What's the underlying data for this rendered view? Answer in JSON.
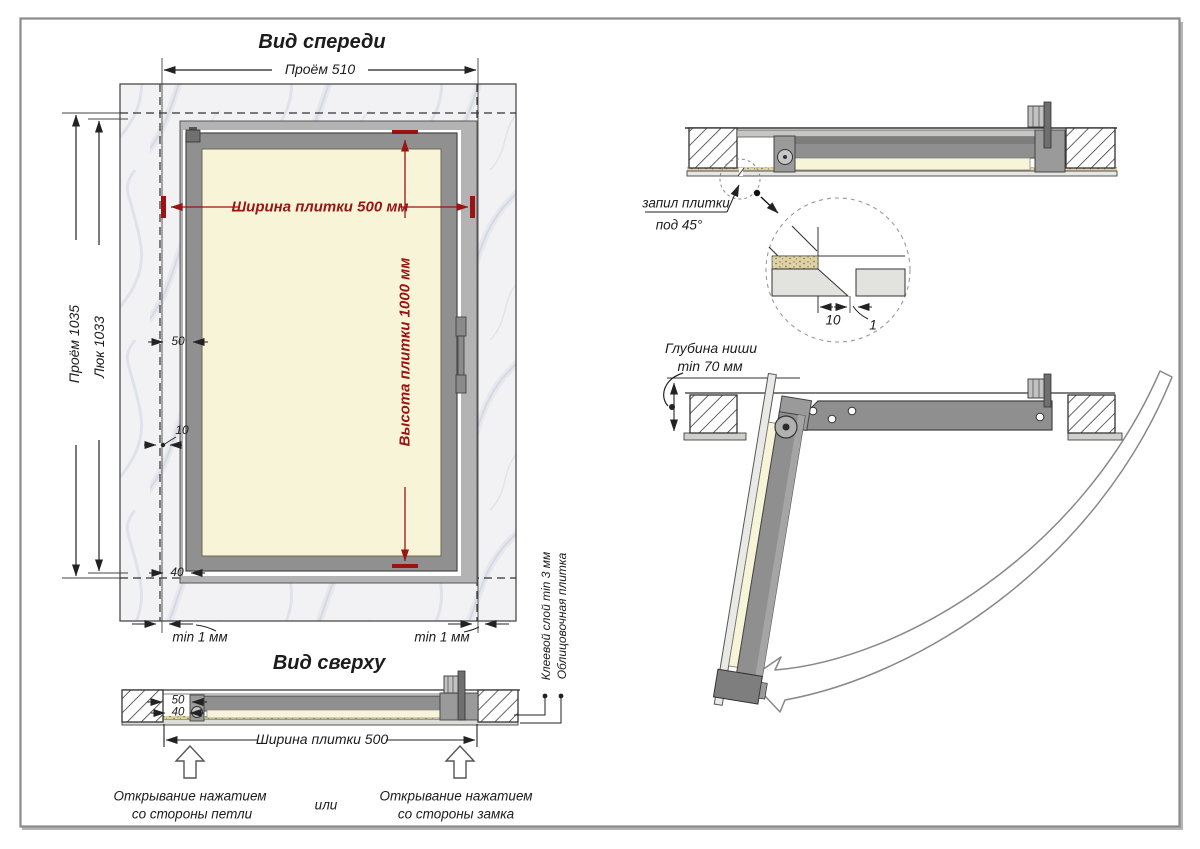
{
  "colors": {
    "dim_red": "#9b1313",
    "line": "#222222",
    "door_gray": "#8f8f8f",
    "frame_gray": "#b3b3b3",
    "tile_cream": "#f8f4d8",
    "wall_light": "#f2f2f5"
  },
  "front_view": {
    "title": "Вид спереди",
    "dim_opening_width": "Проём 510",
    "dim_tile_width": "Ширина плитки 500 мм",
    "dim_tile_height": "Высота плитки 1000 мм",
    "dim_opening_height": "Проём 1035",
    "dim_hatch_height": "Люк 1033",
    "dim_50": "50",
    "dim_10": "10",
    "dim_40": "40",
    "gap_left": "min 1 мм",
    "gap_right": "min 1 мм"
  },
  "top_view": {
    "title": "Вид сверху",
    "dim_50": "50",
    "dim_40": "40",
    "dim_width": "Ширина плитки 500",
    "open_hinge": [
      "Открывание нажатием",
      "со стороны петли"
    ],
    "or_label": "или",
    "open_lock": [
      "Открывание нажатием",
      "со стороны замка"
    ],
    "glue_label": "Клеевой слой min 3 мм",
    "tile_label": "Облицовочная плитка"
  },
  "section_view": {
    "cut_label": [
      "запил плитки",
      "под 45°"
    ],
    "detail_dim_width": "10",
    "detail_dim_gap": "1"
  },
  "open_view": {
    "depth_label": [
      "Глубина ниши",
      "min 70 мм"
    ]
  }
}
